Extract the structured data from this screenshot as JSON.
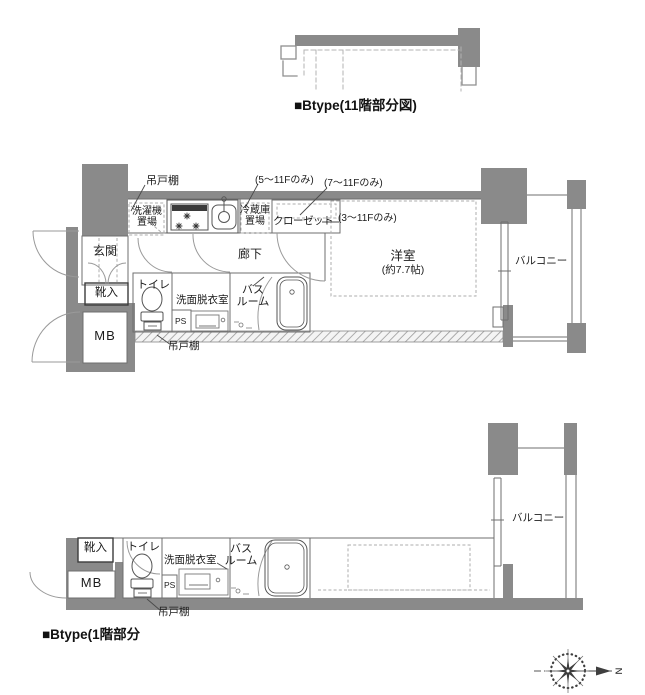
{
  "colors": {
    "wall_gray": "#8a8a8a",
    "line_gray": "#6f6f6f",
    "dash_gray": "#adadad",
    "text": "#1c1c1c"
  },
  "captions": {
    "upper": "■Btype(11階部分図)",
    "lower": "■Btype(1階部分"
  },
  "middle_plan": {
    "labels": {
      "hang_cupboard_top": "吊戸棚",
      "note_5f": "(5〜11Fのみ)",
      "note_7f": "(7〜11Fのみ)",
      "note_3f": "(3〜11Fのみ)",
      "washing_machine": "洗濯機\n置場",
      "fridge": "冷蔵庫\n置場",
      "closet": "クローゼット",
      "corridor": "廊下",
      "entrance": "玄関",
      "shoe_box": "靴入",
      "meter_box": "MB",
      "toilet": "トイレ",
      "washroom": "洗面脱衣室",
      "bathroom": "バス\nルーム",
      "pipe_space": "PS",
      "western_room": "洋室",
      "western_room_size": "(約7.7帖)",
      "balcony": "バルコニー",
      "hang_cupboard_bottom": "吊戸棚"
    }
  },
  "bottom_plan": {
    "labels": {
      "shoe_box": "靴入",
      "meter_box": "MB",
      "toilet": "トイレ",
      "washroom": "洗面脱衣室",
      "bathroom": "バス\nルーム",
      "pipe_space": "PS",
      "balcony": "バルコニー",
      "hang_cupboard_bottom": "吊戸棚"
    }
  },
  "compass": {
    "north_label": "N"
  }
}
